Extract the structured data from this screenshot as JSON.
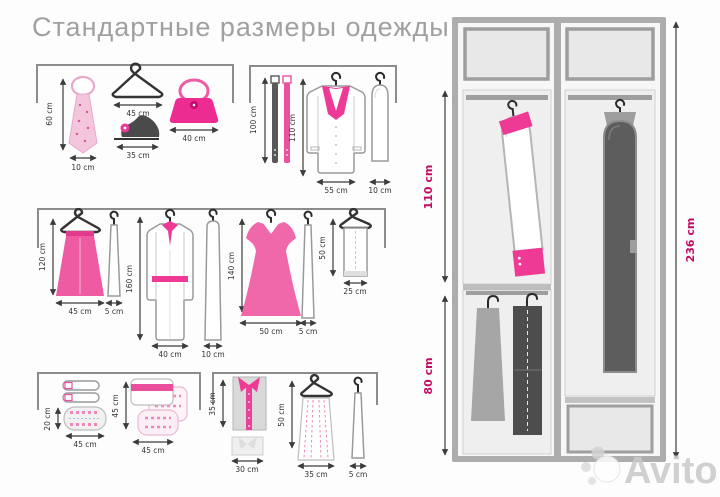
{
  "title": "Стандартные размеры одежды",
  "watermark": {
    "brand": "Avito"
  },
  "colors": {
    "accent_pink": "#ee3a95",
    "bright_pink": "#ec2c90",
    "pale_pink": "#f3c6dc",
    "label_pink": "#c40b63",
    "stroke_dark": "#3c3c3c",
    "title_gray": "#a0a0a0",
    "frame_gray": "#adadad",
    "dark_bag_gray": "#5d5d5d"
  },
  "panels": {
    "accessories": {
      "tie": {
        "height": "60 cm",
        "width": "10 cm"
      },
      "hanger": {
        "width": "45 cm"
      },
      "shoes": {
        "width": "35 cm"
      },
      "handbag": {
        "width": "40 cm"
      }
    },
    "outerwear": {
      "belts": {
        "length": "100 cm"
      },
      "coat": {
        "height": "110 cm",
        "width": "55 cm"
      },
      "cover": {
        "width": "10 cm"
      }
    },
    "dresses": {
      "skirt": {
        "height": "120 cm",
        "width": "45 cm"
      },
      "skirt_cover": {
        "width": "5 cm"
      },
      "robe": {
        "height": "160 cm",
        "width": "40 cm"
      },
      "robe_cover": {
        "width": "10 cm"
      },
      "dress": {
        "height": "140 cm",
        "width": "50 cm"
      },
      "dress_cover": {
        "width": "5 cm"
      },
      "folded_trousers": {
        "height": "50 cm",
        "width": "25 cm"
      }
    },
    "folded": {
      "knit_pile": {
        "height": "20 cm",
        "width": "45 cm"
      },
      "sweater_stack": {
        "height": "45 cm",
        "width": "45 cm"
      }
    },
    "shirts": {
      "folded_shirt": {
        "height": "35 cm",
        "width": "30 cm"
      },
      "hanging_skirt": {
        "height": "50 cm",
        "width": "35 cm"
      },
      "narrow_cover": {
        "width": "5 cm"
      }
    }
  },
  "wardrobe": {
    "upper_section": "110 cm",
    "lower_section": "80 cm",
    "total_height": "236 cm"
  }
}
